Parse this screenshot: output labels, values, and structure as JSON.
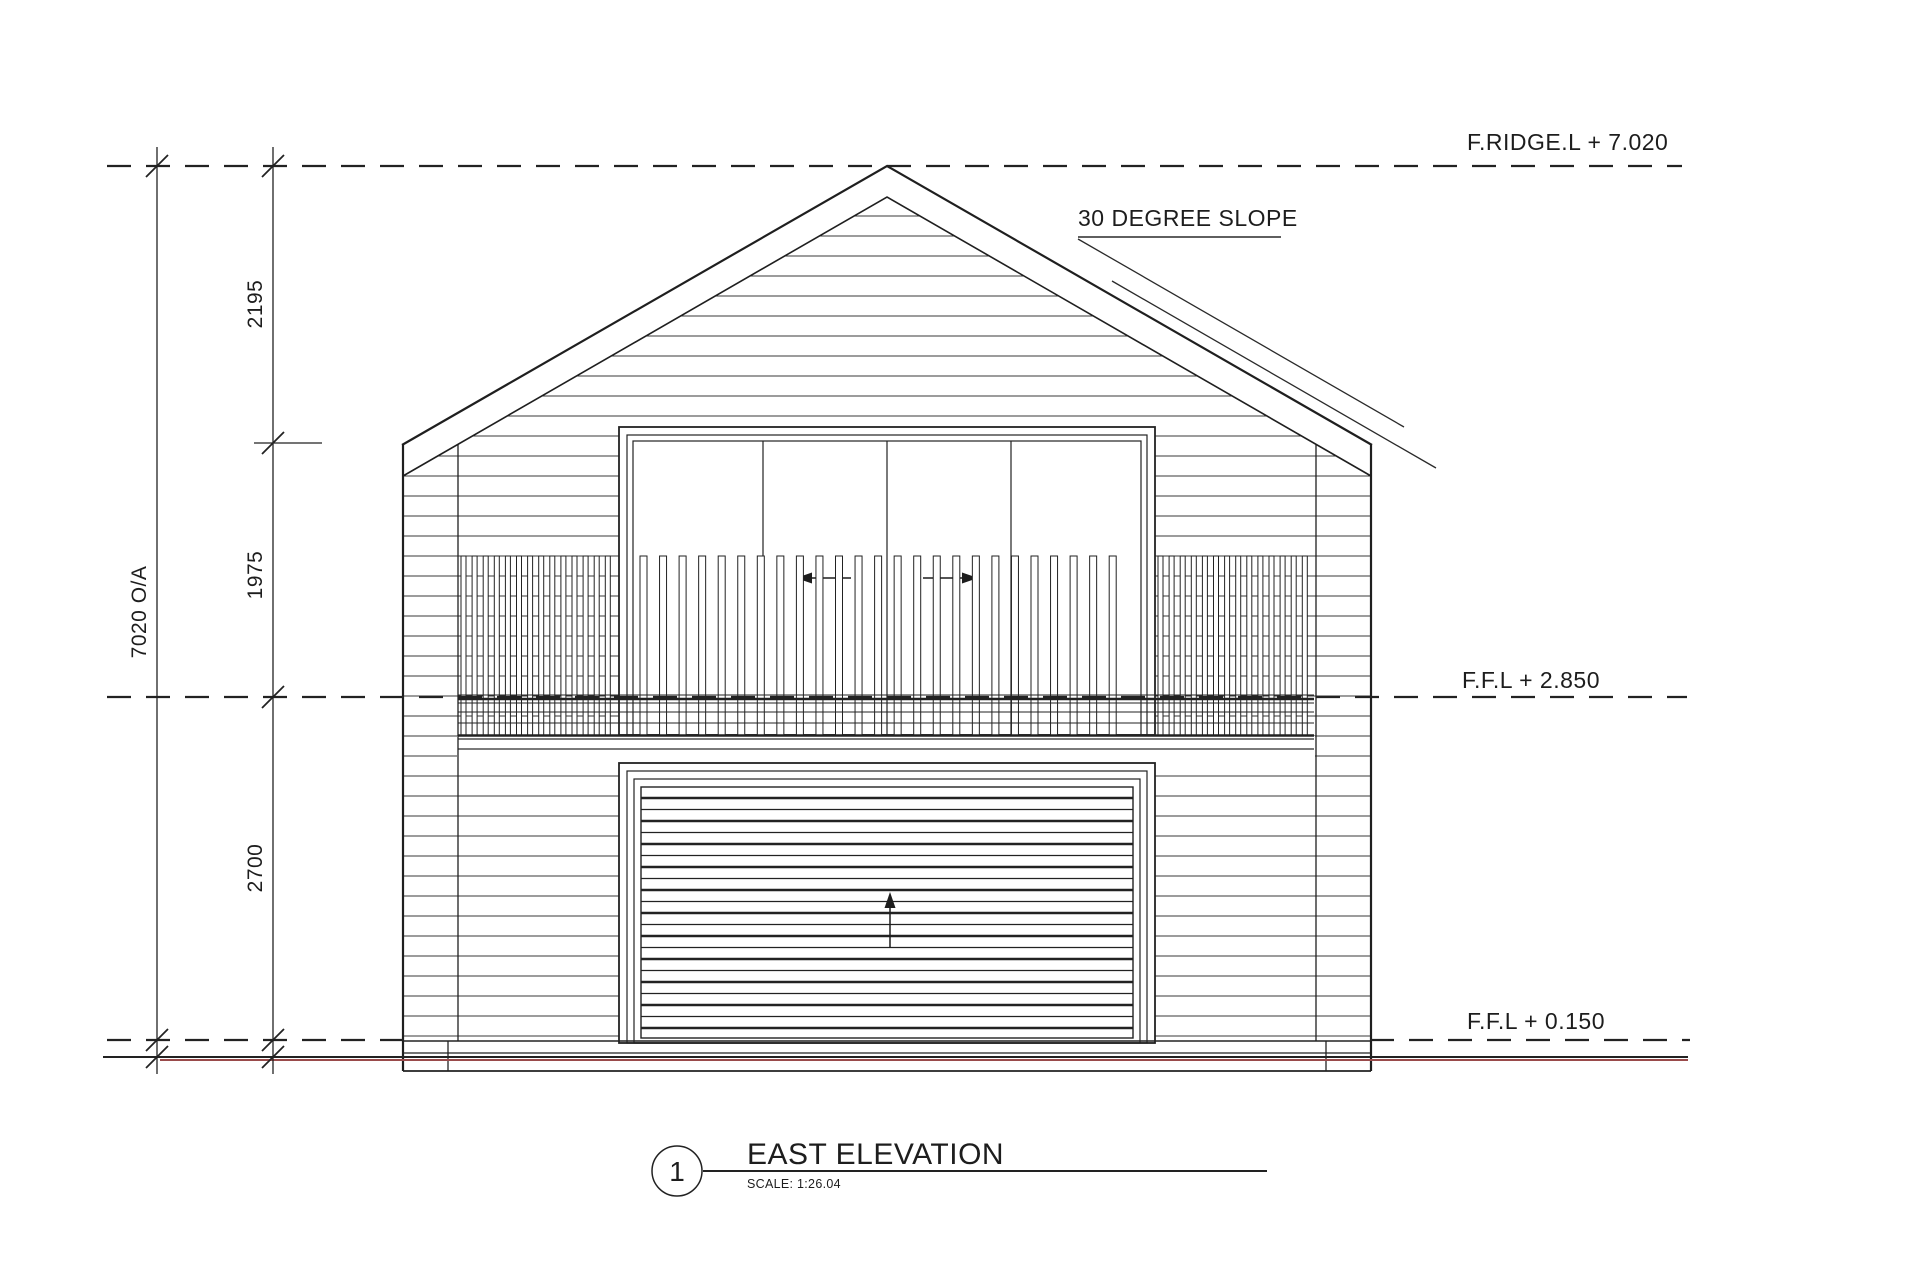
{
  "drawing": {
    "type": "architectural-elevation"
  },
  "levels": {
    "ridge_label": "F.RIDGE.L + 7.020",
    "upper_floor_label": "F.F.L + 2.850",
    "ground_floor_label": "F.F.L + 0.150"
  },
  "dimensions": {
    "overall": "7020 O/A",
    "gable": "2195",
    "upper": "1975",
    "lower": "2700"
  },
  "annotations": {
    "roof_slope": "30 DEGREE SLOPE"
  },
  "title_block": {
    "number": "1",
    "title": "EAST ELEVATION",
    "scale": "SCALE: 1:26.04"
  },
  "colors": {
    "line": "#1f1f1f",
    "ground_line_red": "#9a4b4b"
  }
}
